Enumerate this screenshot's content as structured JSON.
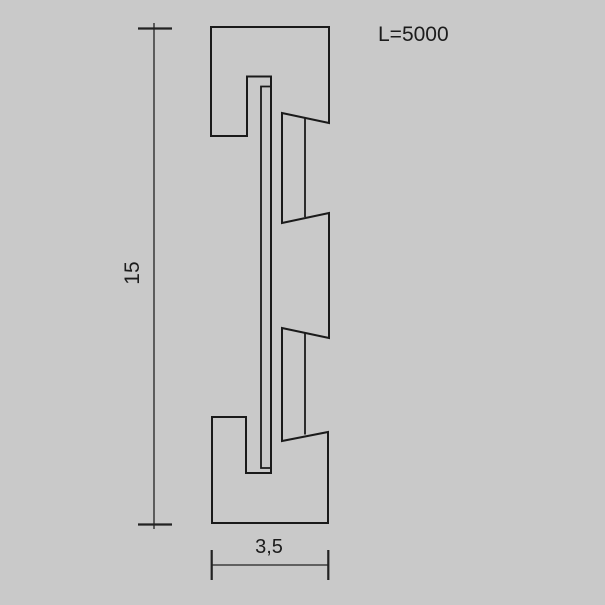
{
  "canvas": {
    "background_color": "#c9c9c9",
    "line_color": "#1a1a1a",
    "text_color": "#1c1c1c"
  },
  "labels": {
    "length": "L=5000",
    "height": "15",
    "width": "3,5"
  },
  "drawing": {
    "profile_outline_points": "211,27 329,27 329,123 282,113 282,223 329,213 329,338 282,328 282,441 328,432 328,523 212,523 212,417 246,417 246,473 271,473 271,76.5 247,76.5 247,136 211,136",
    "trim_inner_points": "271,86.5 261,86.5 261,468 271.5,468",
    "tooth_upper_depth_points": "305,118 305,217",
    "tooth_lower_depth_points": "305,333 305,434.5",
    "height_dim_line_points": "154,23 154,529",
    "height_dim_top_tick_points": "138,28.5 172,28.5",
    "height_dim_bottom_tick_points": "138,524.5 172,524.5",
    "width_dim_line_points": "211.7,565 328.3,565",
    "width_dim_left_tick_points": "211.7,550 211.7,580",
    "width_dim_right_tick_points": "328.3,550 328.3,580"
  }
}
